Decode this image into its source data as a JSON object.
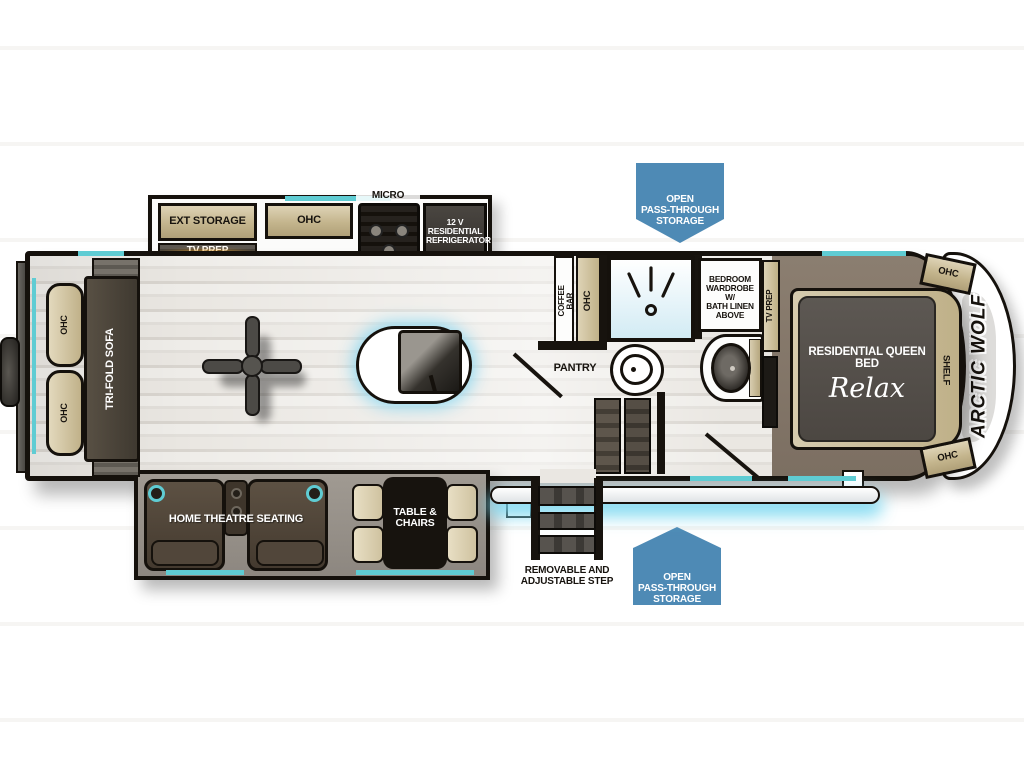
{
  "callouts": {
    "storage_top": "OPEN\nPASS-THROUGH\nSTORAGE",
    "storage_bottom": "OPEN\nPASS-THROUGH\nSTORAGE",
    "step": "REMOVABLE AND\nADJUSTABLE STEP"
  },
  "kitchen_slide": {
    "ext_storage": "EXT STORAGE",
    "tv_prep": "TV PREP",
    "ohc": "OHC",
    "micro": "MICRO",
    "refrigerator": "12 V\nRESIDENTIAL\nREFRIGERATOR"
  },
  "galley": {
    "fireplace": "FIREPLACE",
    "coffee_bar": "COFFEE BAR",
    "ohc": "OHC",
    "pantry": "PANTRY"
  },
  "rear": {
    "sofa": "TRI-FOLD SOFA",
    "ohc_top": "OHC",
    "ohc_bottom": "OHC"
  },
  "bath": {
    "wardrobe": "BEDROOM\nWARDROBE W/\nBATH LINEN\nABOVE"
  },
  "bedroom": {
    "tv_prep": "TV PREP",
    "bed_label": "RESIDENTIAL QUEEN BED",
    "bed_logo": "Relax",
    "shelf": "SHELF",
    "ohc_top": "OHC",
    "ohc_bottom": "OHC",
    "brand": "ARCTIC WOLF"
  },
  "living_slide": {
    "hts": "HOME THEATRE SEATING",
    "table": "TABLE &\nCHAIRS"
  },
  "colors": {
    "flag_blue": "#4e8ab5",
    "window_teal": "#5fccd3",
    "cabinet_tan": "#cfc2a2",
    "dark_appliance": "#3d3936",
    "bedroom_carpet": "#84776a",
    "fireplace_glow": "#f7a41f",
    "awning_glow": "#8fdef2"
  }
}
